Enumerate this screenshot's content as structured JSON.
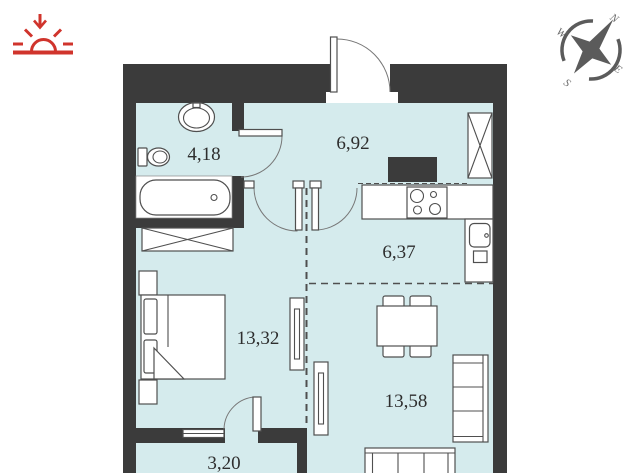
{
  "plan": {
    "type": "apartment-floor-plan",
    "rooms": [
      {
        "id": "bathroom",
        "area": "4,18"
      },
      {
        "id": "hallway",
        "area": "6,92"
      },
      {
        "id": "kitchen",
        "area": "6,37"
      },
      {
        "id": "bedroom",
        "area": "13,32"
      },
      {
        "id": "living-room",
        "area": "13,58"
      },
      {
        "id": "balcony",
        "area": "3,20"
      }
    ],
    "compass": {
      "n": "N",
      "e": "E",
      "s": "S",
      "w": "W"
    },
    "colors": {
      "floor": "#d5ebed",
      "wall": "#3b3b3b",
      "accent_red": "#d0342c",
      "line": "#4f4f4f"
    }
  }
}
